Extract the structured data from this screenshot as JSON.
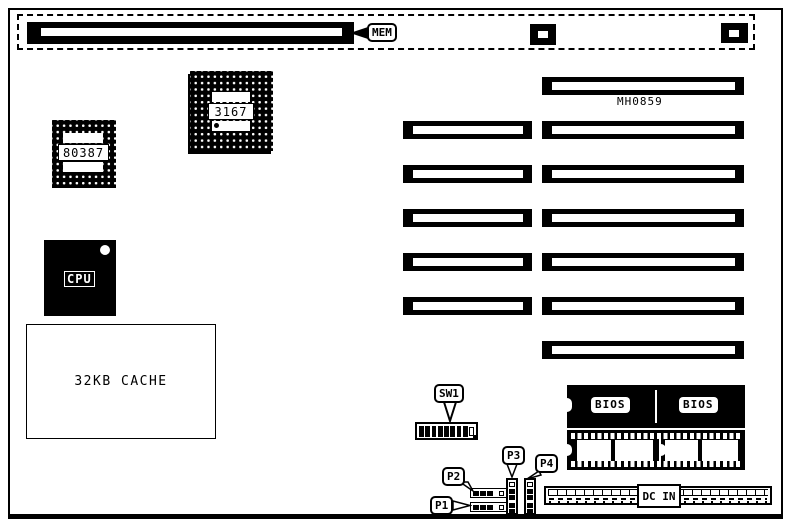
{
  "board_id": "MH0859",
  "memory": {
    "callout": "MEM"
  },
  "chips": {
    "chipset": "3167",
    "coprocessor": "80387",
    "cpu": "CPU",
    "cache": "32KB CACHE"
  },
  "bios": {
    "left_label": "BIOS",
    "right_label": "BIOS"
  },
  "dip_switch": {
    "callout": "SW1",
    "filled_positions": 8,
    "open_positions": 1
  },
  "connectors": {
    "p1": "P1",
    "p2": "P2",
    "p3": "P3",
    "p4": "P4",
    "dc_in": "DC IN"
  },
  "expansion_slots": {
    "left_column_count": 5,
    "right_column_count": 7
  }
}
